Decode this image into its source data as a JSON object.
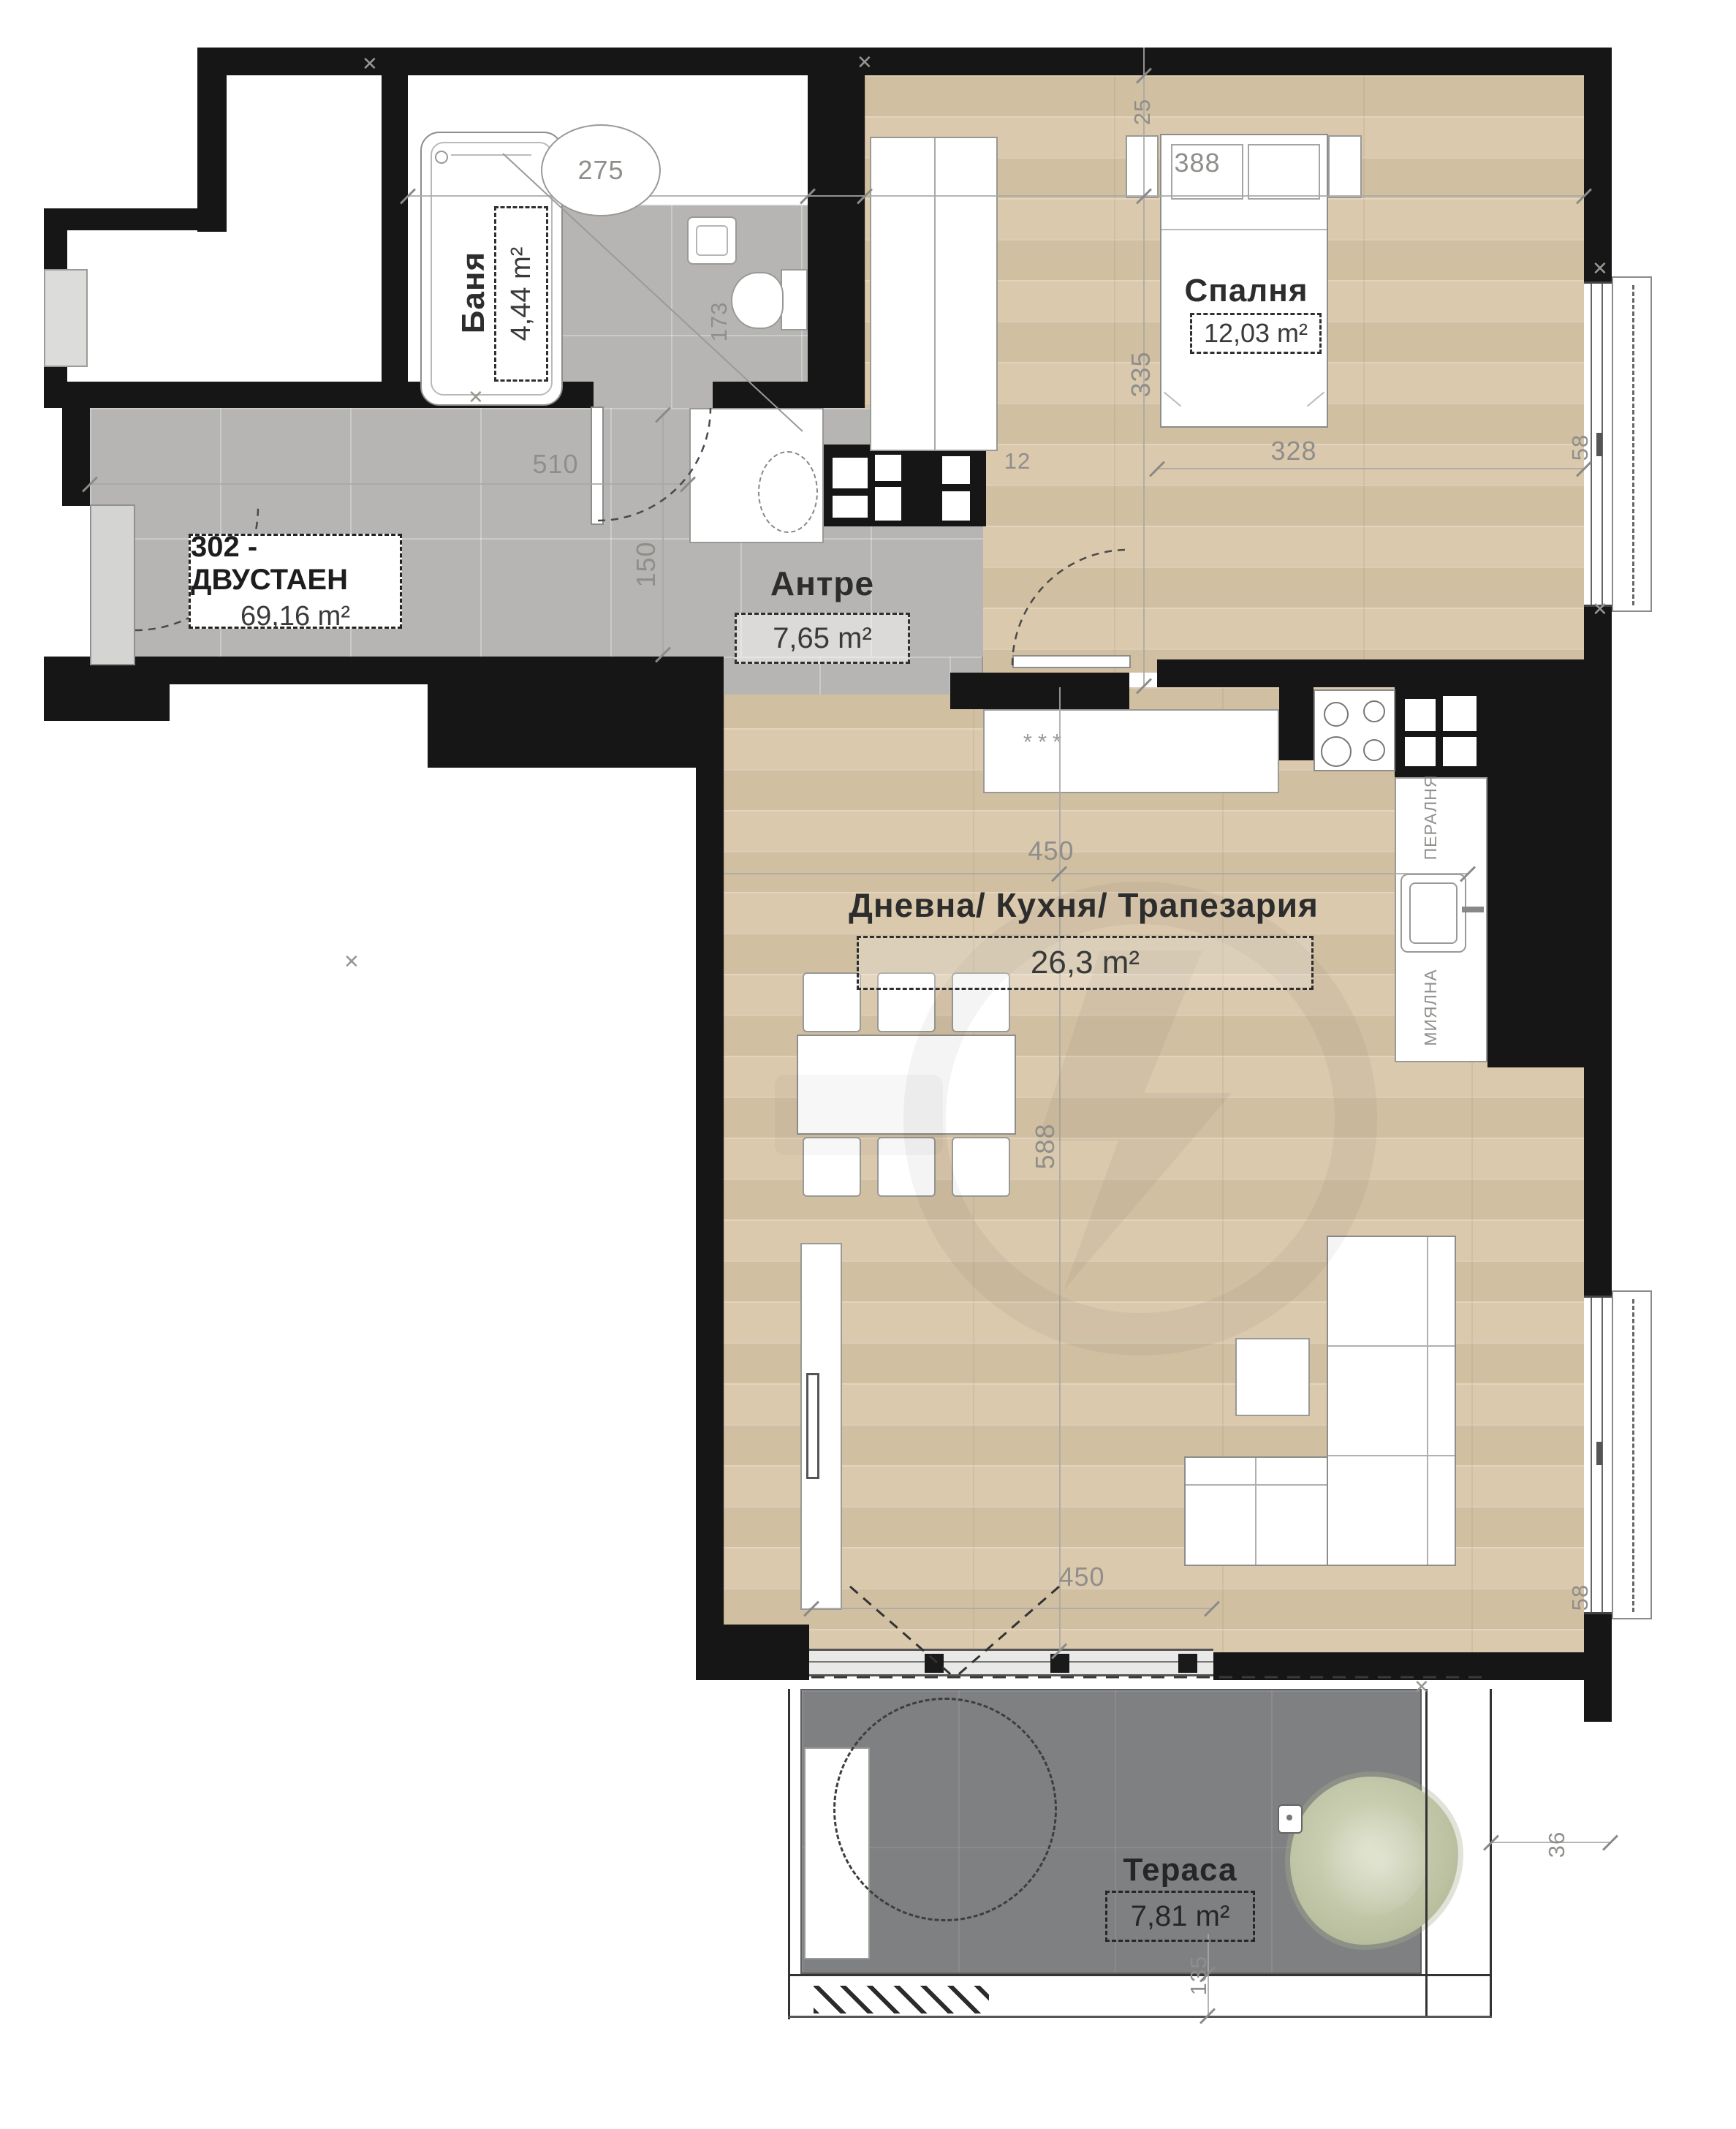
{
  "unit": {
    "label": "302 - ДВУСТАЕН",
    "area": "69,16 m²"
  },
  "rooms": {
    "bathroom": {
      "name": "Баня",
      "area": "4,44 m²"
    },
    "bedroom": {
      "name": "Спалня",
      "area": "12,03 m²"
    },
    "hallway": {
      "name": "Антре",
      "area": "7,65 m²"
    },
    "living": {
      "name": "Дневна/ Кухня/ Трапезария",
      "area": "26,3 m²"
    },
    "terrace": {
      "name": "Тераса",
      "area": "7,81 m²"
    }
  },
  "appliances": {
    "washer": "ПЕРАЛНЯ",
    "dishwasher": "МИЯЛНА",
    "counter_marks": "***"
  },
  "dimensions": {
    "bath_width": "275",
    "toilet_niche": "173",
    "hall_width": "510",
    "hall_depth": "150",
    "bedroom_width": "388",
    "wall_offset": "25",
    "bedroom_depth": "335",
    "bed_width": "328",
    "bedroom_window": "58",
    "shaft": "12",
    "kitchen_width": "450",
    "living_depth": "588",
    "terrace_door": "450",
    "living_window": "58",
    "terrace_right": "36",
    "terrace_side": "135"
  },
  "colors": {
    "wall": "#161616",
    "tile": "#b6b5b3",
    "wood": "#d9c6a8",
    "terr": "#7e8082"
  }
}
